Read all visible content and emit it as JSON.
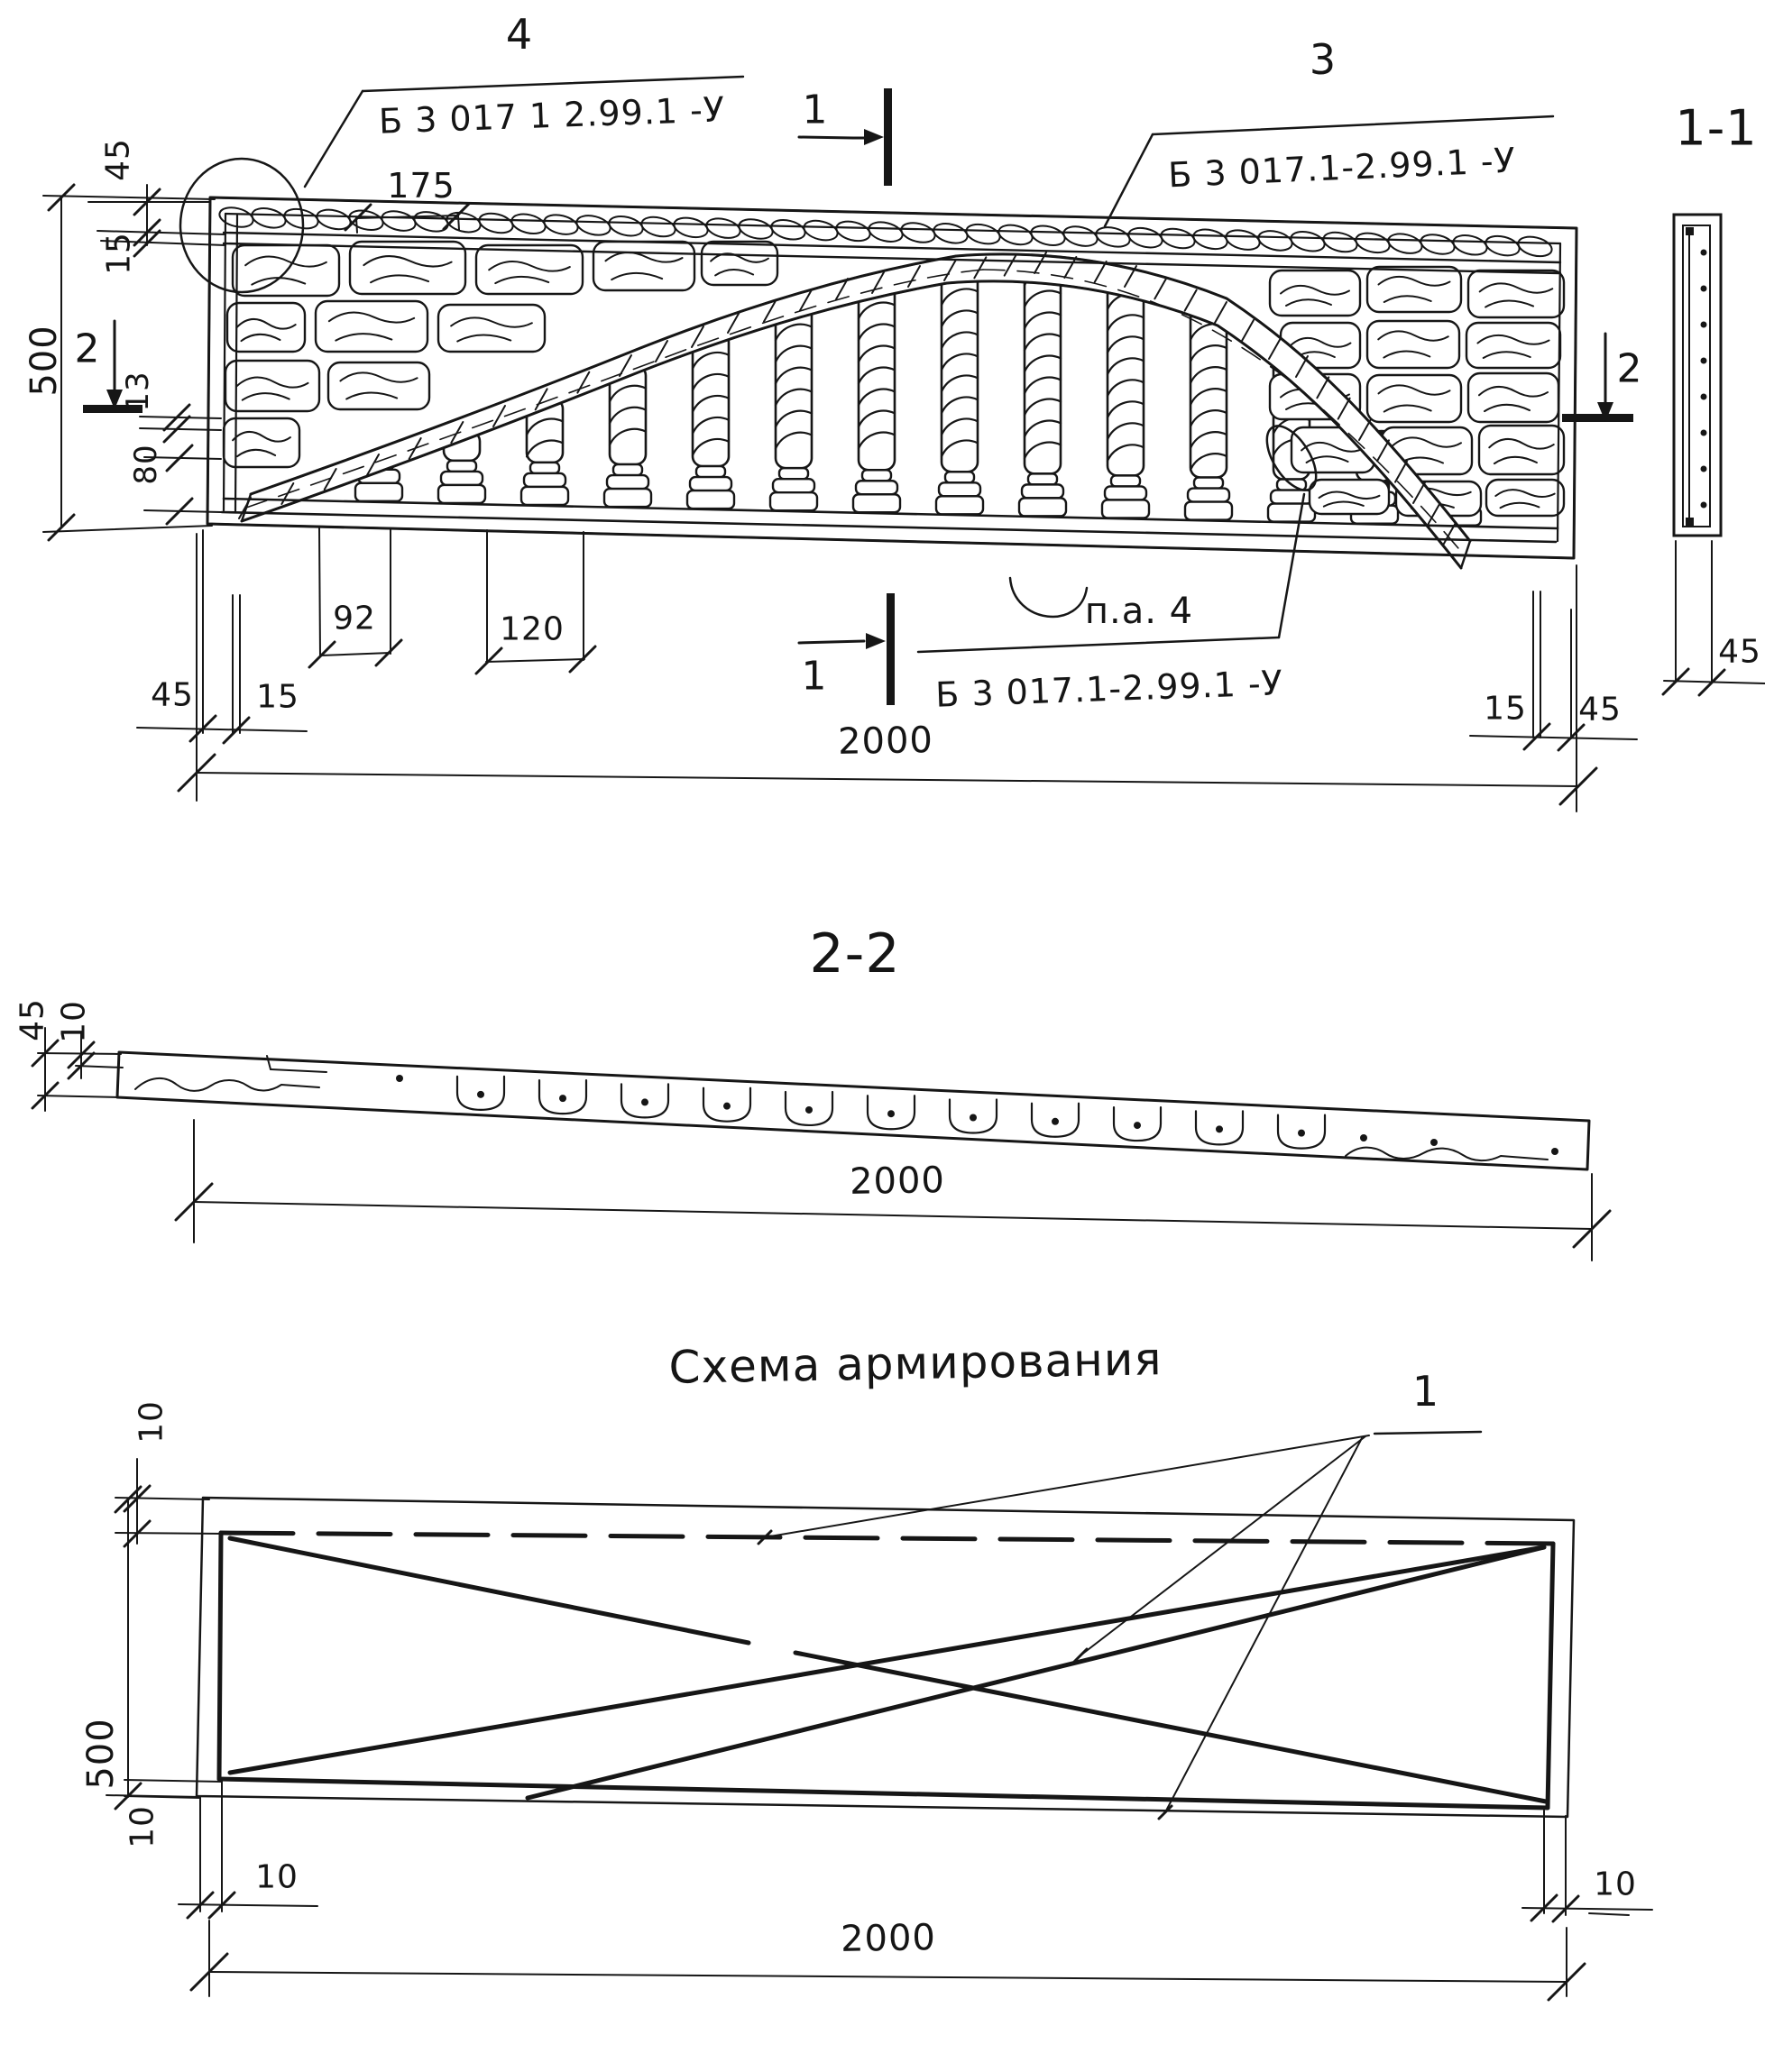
{
  "meta": {
    "kind": "precast concrete decorative fence panel working drawing",
    "language": "ru"
  },
  "elevation": {
    "callout_4": {
      "num": "4",
      "code": "Б 3 017 1 2.99.1  -У"
    },
    "callout_3": {
      "num": "3",
      "code": "Б 3 017.1-2.99.1  -У"
    },
    "detail_callout": {
      "ref": "п.а. 4",
      "code": "Б 3 017.1-2.99.1  -У"
    },
    "section_marks": {
      "s1": "1",
      "s2": "2"
    },
    "dims": {
      "band_height": "45",
      "band_gap": "15",
      "height": "500",
      "rail_gap": "13",
      "base_height": "80",
      "stone_width": "175",
      "baluster_gap": "92",
      "baluster_pitch": "120",
      "edge_left": "45",
      "inset_left": "15",
      "inset_right": "15",
      "edge_right": "45",
      "length": "2000",
      "section_thickness": "45"
    },
    "section_1_1": {
      "label": "1-1"
    }
  },
  "section_2_2": {
    "label": "2-2",
    "dims": {
      "thickness": "45",
      "offset": "10",
      "length": "2000"
    }
  },
  "reinforcement": {
    "title": "Схема армирования",
    "bar_mark": "1",
    "dims": {
      "cover_top": "10",
      "height": "500",
      "cover_bottom": "10",
      "cover_b_left": "10",
      "cover_b_right": "10",
      "length": "2000"
    }
  }
}
